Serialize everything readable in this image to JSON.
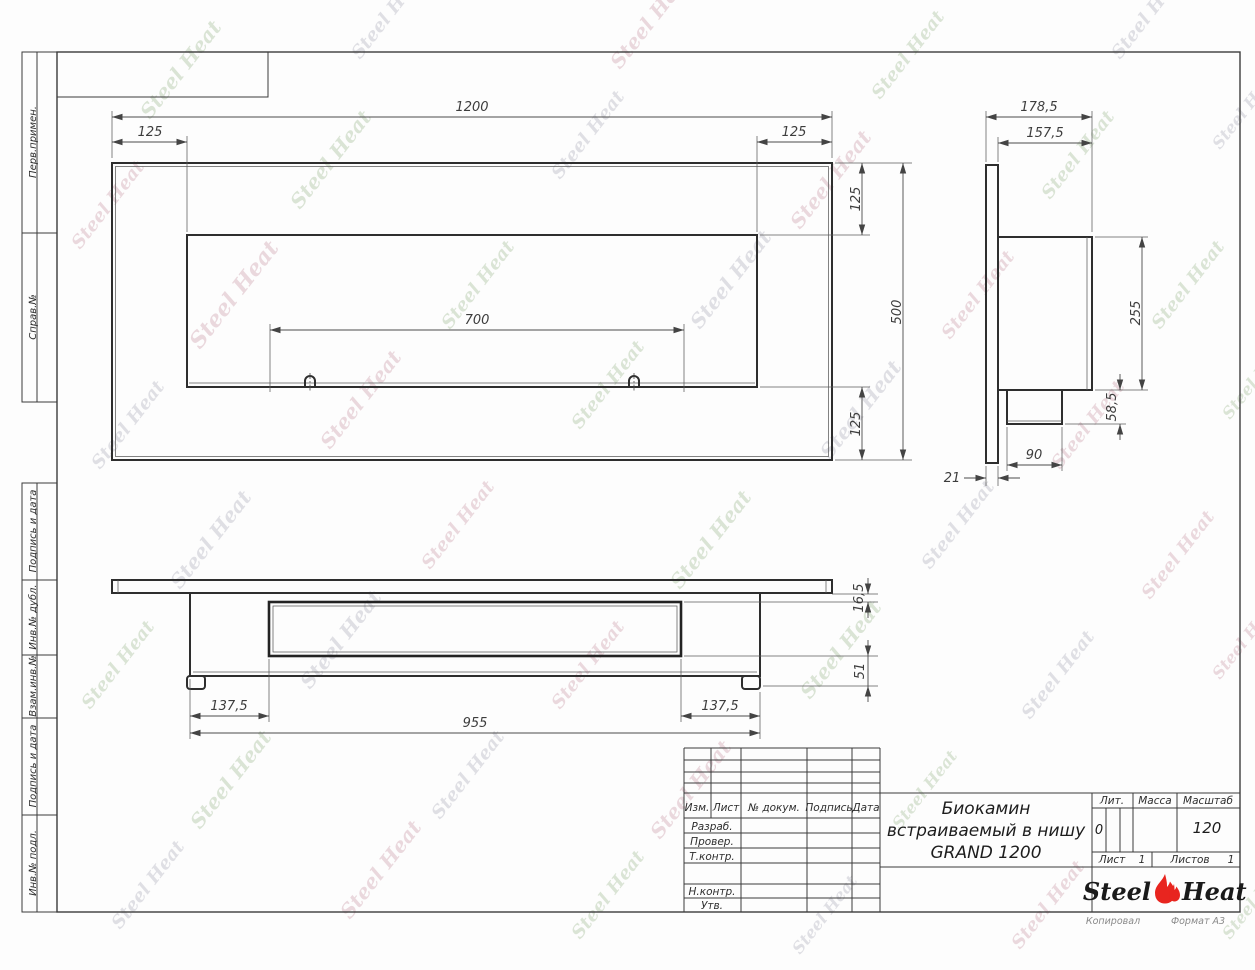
{
  "frame_labels": {
    "items": [
      {
        "label": "Перв.примен."
      },
      {
        "label": "Справ.№"
      },
      {
        "label": "Подпись и дата"
      },
      {
        "label": "Инв.№ дубл."
      },
      {
        "label": "Взам.инв.№"
      },
      {
        "label": "Подпись и дата"
      },
      {
        "label": "Инв.№ подл."
      }
    ]
  },
  "dims": {
    "front": {
      "width": "1200",
      "left": "125",
      "right": "125",
      "top": "125",
      "height": "500",
      "bottom": "125",
      "burner": "700"
    },
    "side": {
      "total_depth": "178,5",
      "body_depth": "157,5",
      "body_height": "255",
      "box_height": "58,5",
      "box_depth": "90",
      "panel": "21"
    },
    "bottom": {
      "inset_left": "137,5",
      "body_width": "955",
      "inset_right": "137,5",
      "lip": "16,5",
      "depth": "51"
    }
  },
  "title_block": {
    "revision_cols": [
      "Изм.",
      "Лист",
      "№ докум.",
      "Подпись",
      "Дата"
    ],
    "staff_rows": [
      "Разраб.",
      "Провер.",
      "Т.контр.",
      "Н.контр.",
      "Утв."
    ],
    "title_line1": "Биокамин",
    "title_line2": "встраиваемый в нишу",
    "title_line3": "GRAND 1200",
    "lit_label": "Лит.",
    "lit_value": "0",
    "mass_label": "Масса",
    "scale_label": "Масштаб",
    "scale_value": "120",
    "sheet_label": "Лист",
    "sheet_value": "1",
    "sheets_label": "Листов",
    "sheets_value": "1",
    "logo_steel": "Steel",
    "logo_heat": "Heat",
    "accent_color": "#e8251f",
    "kopiroval": "Копировал",
    "format": "Формат А3"
  },
  "watermark": {
    "text": "Steel Heat",
    "colors": [
      "#b7cbae",
      "#c2c2cb",
      "#d8b4bd"
    ],
    "positions": [
      [
        150,
        120,
        20
      ],
      [
        360,
        60,
        18
      ],
      [
        620,
        70,
        20
      ],
      [
        880,
        100,
        18
      ],
      [
        1120,
        60,
        18
      ],
      [
        80,
        250,
        18
      ],
      [
        300,
        210,
        20
      ],
      [
        560,
        180,
        18
      ],
      [
        800,
        230,
        20
      ],
      [
        1050,
        200,
        18
      ],
      [
        1220,
        150,
        16
      ],
      [
        200,
        350,
        22
      ],
      [
        450,
        330,
        18
      ],
      [
        700,
        330,
        20
      ],
      [
        950,
        340,
        18
      ],
      [
        1160,
        330,
        18
      ],
      [
        100,
        470,
        18
      ],
      [
        330,
        450,
        20
      ],
      [
        580,
        430,
        18
      ],
      [
        830,
        460,
        20
      ],
      [
        1060,
        470,
        18
      ],
      [
        1230,
        420,
        16
      ],
      [
        180,
        590,
        20
      ],
      [
        430,
        570,
        18
      ],
      [
        680,
        590,
        20
      ],
      [
        930,
        570,
        18
      ],
      [
        1150,
        600,
        18
      ],
      [
        90,
        710,
        18
      ],
      [
        310,
        690,
        20
      ],
      [
        560,
        710,
        18
      ],
      [
        810,
        700,
        20
      ],
      [
        1030,
        720,
        18
      ],
      [
        1220,
        680,
        16
      ],
      [
        200,
        830,
        20
      ],
      [
        440,
        820,
        18
      ],
      [
        660,
        840,
        20
      ],
      [
        900,
        830,
        16
      ],
      [
        120,
        930,
        18
      ],
      [
        350,
        920,
        20
      ],
      [
        580,
        940,
        18
      ],
      [
        800,
        955,
        16
      ],
      [
        1020,
        950,
        18
      ],
      [
        1230,
        940,
        16
      ]
    ]
  }
}
